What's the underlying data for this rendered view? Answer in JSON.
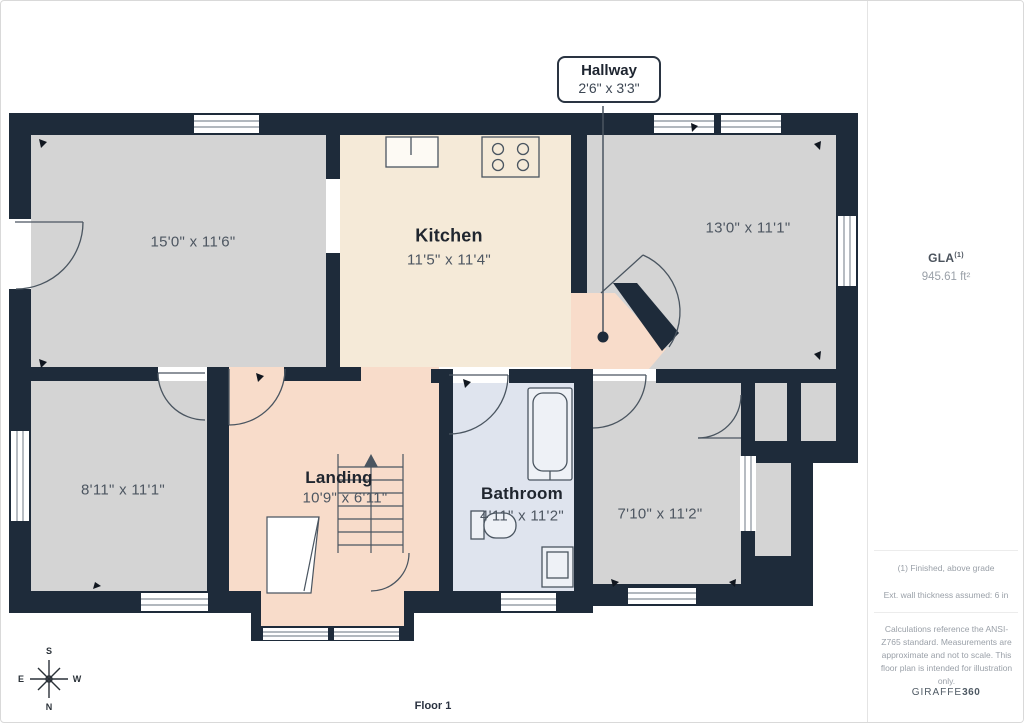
{
  "floor": {
    "label": "Floor 1"
  },
  "callout": {
    "title": "Hallway",
    "dims": "2'6\" x 3'3\""
  },
  "rooms": {
    "top_left": {
      "dims": "15'0\" x 11'6\""
    },
    "kitchen": {
      "name": "Kitchen",
      "dims": "11'5\" x 11'4\""
    },
    "top_right": {
      "dims": "13'0\" x 11'1\""
    },
    "bottom_left": {
      "dims": "8'11\" x 11'1\""
    },
    "landing": {
      "name": "Landing",
      "dims": "10'9\" x 6'11\""
    },
    "bathroom": {
      "name": "Bathroom",
      "dims": "4'11\" x 11'2\""
    },
    "bottom_right": {
      "dims": "7'10\" x 11'2\""
    }
  },
  "sidebar": {
    "gla_label": "GLA",
    "gla_superscript": "(1)",
    "gla_value": "945.61 ft²",
    "footnote_1": "(1) Finished, above grade",
    "footnote_2": "Ext. wall thickness assumed: 6 in",
    "disclaimer": "Calculations reference the ANSI-Z765 standard. Measurements are approximate and not to scale. This floor plan is intended for illustration only.",
    "brand_name": "GIRAFFE",
    "brand_suffix": "360"
  },
  "compass": {
    "top": "S",
    "left": "E",
    "right": "W",
    "bottom": "N"
  },
  "palette": {
    "wall": "#1e2b3a",
    "room_gray": "#d4d4d4",
    "kitchen_cream": "#f5ead8",
    "hall_peach": "#f8dcca",
    "bathroom_blue": "#dfe4ee",
    "detail_line": "#4a5560",
    "dimension_text": "#4d5661",
    "room_name_text": "#20262f"
  }
}
